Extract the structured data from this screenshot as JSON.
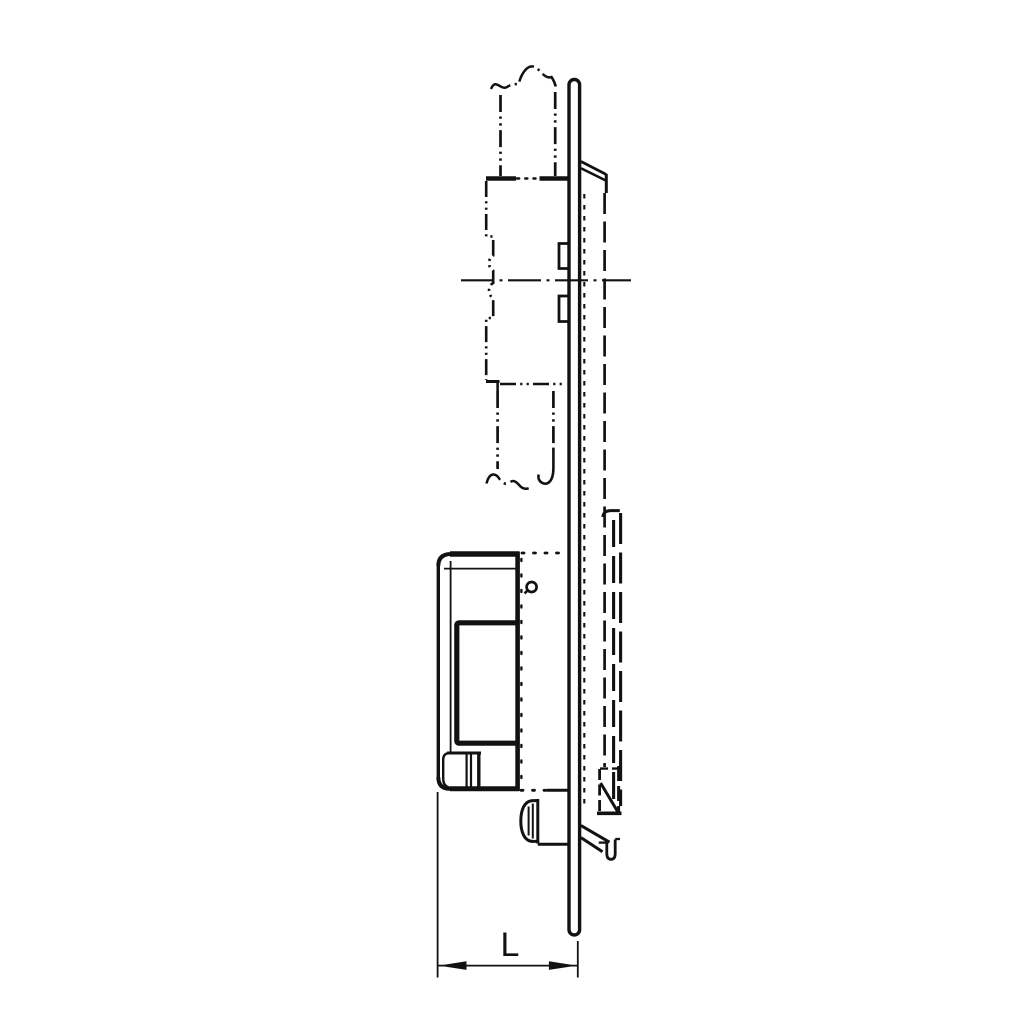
{
  "canvas": {
    "width": 1024,
    "height": 1024,
    "background": "#ffffff",
    "line_color": "#121212"
  },
  "drawing": {
    "kind": "technical line drawing, side elevation",
    "dimension_label": "L",
    "parts": [
      "phantom-door-profile-upper-tube",
      "phantom-profile-box-with-cylinder-bumps",
      "phantom-door-profile-lower-tube",
      "horizontal-center-line",
      "face-plate",
      "rear-cover-panel",
      "strike-keeper-hidden-lines",
      "lock-case",
      "inner-opening",
      "fixing-screw",
      "cylinder-knob",
      "bottom-mounting-tab",
      "dimension-L"
    ]
  }
}
